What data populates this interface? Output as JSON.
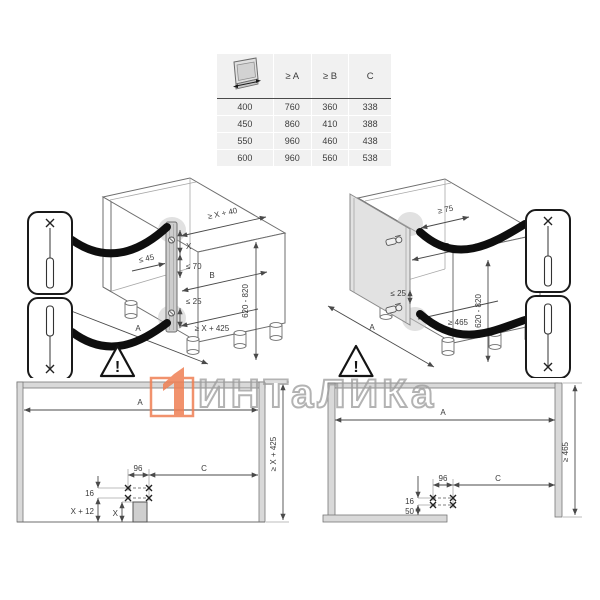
{
  "spec_table": {
    "headers": {
      "a": "≥ A",
      "b": "≥ B",
      "c": "C"
    },
    "rows": [
      {
        "width": "400",
        "a": "760",
        "b": "360",
        "c": "338"
      },
      {
        "width": "450",
        "a": "860",
        "b": "410",
        "c": "388"
      },
      {
        "width": "550",
        "a": "960",
        "b": "460",
        "c": "438"
      },
      {
        "width": "600",
        "a": "960",
        "b": "560",
        "c": "538"
      }
    ]
  },
  "cabinet_front_view": {
    "dim_top_depth": "≥ X + 40",
    "dim_x": "X",
    "dim_max45": "≤ 45",
    "dim_max70": "≤ 70",
    "dim_b": "B",
    "dim_max25": "≤ 25",
    "dim_min_depth": "≥ X + 425",
    "dim_a": "A",
    "dim_height_range": "620 - 820",
    "warning": "!"
  },
  "cabinet_door_view": {
    "dim_top_offset": "≥ 75",
    "dim_b": "B",
    "dim_max25": "≤ 25",
    "dim_min465": "≥ 465",
    "dim_a": "A",
    "dim_height_range": "620 - 820",
    "warning": "!"
  },
  "plan_left": {
    "dim_a": "A",
    "dim_depth": "≥ X + 425",
    "dim_96": "96",
    "dim_c": "C",
    "dim_16": "16",
    "dim_x12": "X + 12",
    "dim_x": "X"
  },
  "plan_right": {
    "dim_a": "A",
    "dim_depth": "≥ 465",
    "dim_96": "96",
    "dim_c": "C",
    "dim_16": "16",
    "dim_50": "50"
  },
  "watermark": {
    "brand": "ИНТаЛИКа",
    "accent_color": "#ef8054",
    "text_outline_color": "#9e9e9e"
  }
}
